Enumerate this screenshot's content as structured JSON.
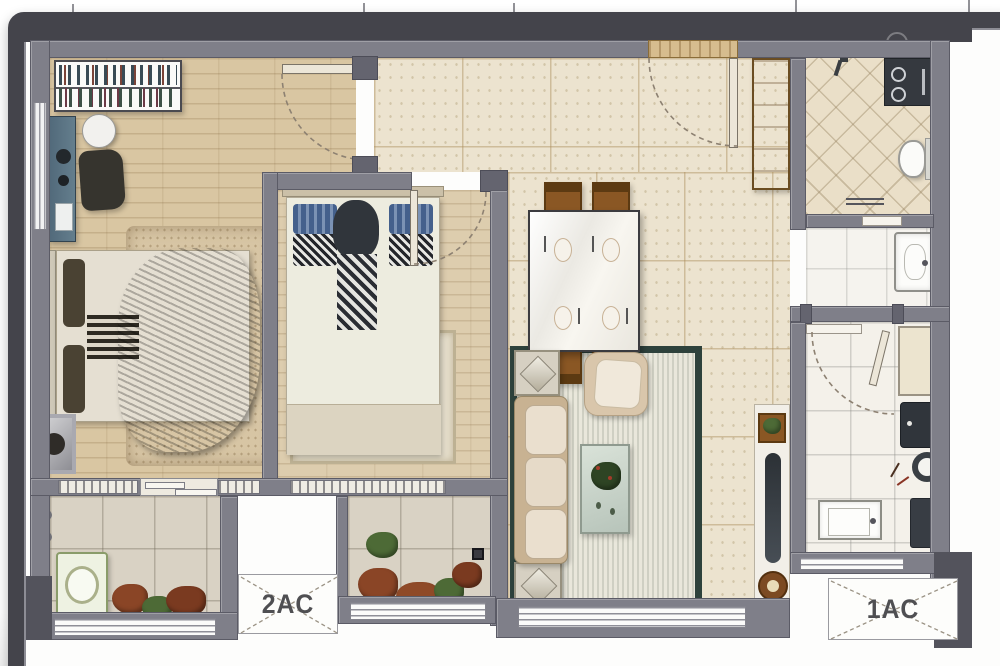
{
  "plan_type": "apartment-floor-plan",
  "ac_platforms": {
    "left_label": "2AC",
    "right_label": "1AC"
  },
  "rooms": [
    {
      "id": "master-bedroom"
    },
    {
      "id": "second-bedroom"
    },
    {
      "id": "hallway-dining"
    },
    {
      "id": "living-area"
    },
    {
      "id": "kitchen"
    },
    {
      "id": "bathroom"
    },
    {
      "id": "wash-basin-niche"
    },
    {
      "id": "laundry-balcony"
    },
    {
      "id": "plant-balcony"
    }
  ],
  "palette": {
    "frame": "#44444b",
    "wall": "#7f7f89",
    "wood": "#d9c6a2",
    "tile": "#ece3cf",
    "bath": "#eadfc8",
    "kitchen": "#f4f1ea",
    "balcony": "#d9d2c4",
    "rugborder": "#2e423c",
    "chairwood": "#8a5724",
    "green": "#4d6a36",
    "rust": "#8a4526",
    "blanket": "#5a5340",
    "pillowblue": "#44608c"
  }
}
